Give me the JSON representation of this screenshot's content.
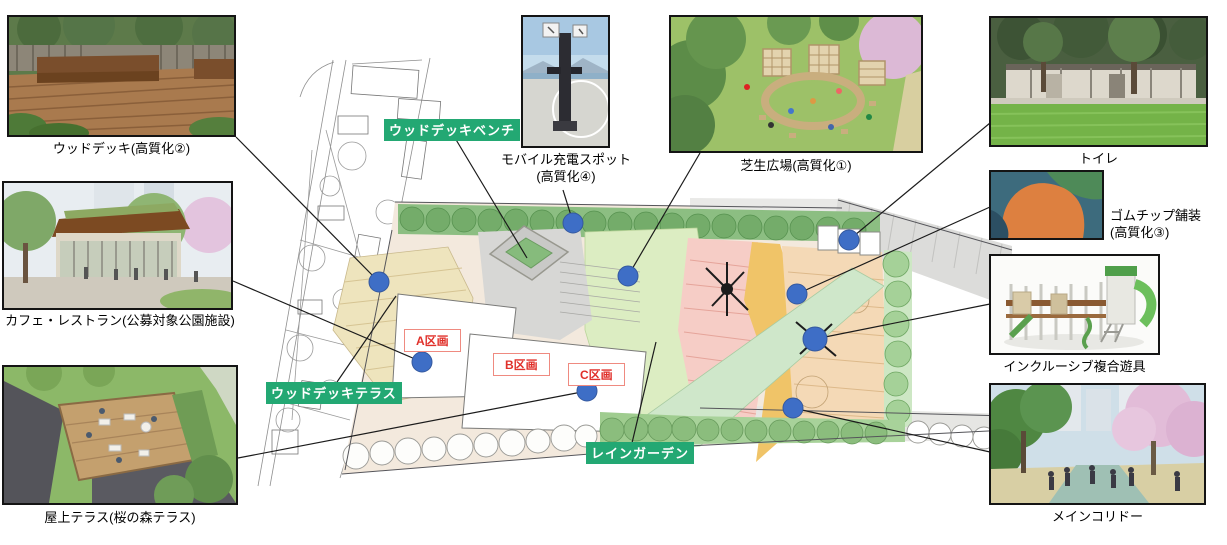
{
  "photos": [
    {
      "id": "wood-deck",
      "caption": "ウッドデッキ(高質化②)"
    },
    {
      "id": "cafe-restaurant",
      "caption": "カフェ・レストラン(公募対象公園施設)"
    },
    {
      "id": "rooftop-terrace",
      "caption": "屋上テラス(桜の森テラス)"
    },
    {
      "id": "mobile-charging",
      "caption": "モバイル充電スポット",
      "caption2": "(高質化④)"
    },
    {
      "id": "lawn-plaza",
      "caption": "芝生広場(高質化①)"
    },
    {
      "id": "toilet",
      "caption": "トイレ"
    },
    {
      "id": "rubber-chip",
      "caption": "ゴムチップ舗装",
      "caption2": "(高質化③)"
    },
    {
      "id": "inclusive-playground",
      "caption": "インクルーシブ複合遊具"
    },
    {
      "id": "main-corridor",
      "caption": "メインコリドー"
    }
  ],
  "map": {
    "green_tags": [
      "ウッドデッキベンチ",
      "ウッドデッキテラス",
      "レインガーデン"
    ],
    "plots": [
      "A区画",
      "B区画",
      "C区画"
    ],
    "marker_color": "#3e6ec6",
    "tag_bg_color": "#23a873",
    "plot_text_color": "#e0302a",
    "plot_border_color": "#ef8a80"
  }
}
